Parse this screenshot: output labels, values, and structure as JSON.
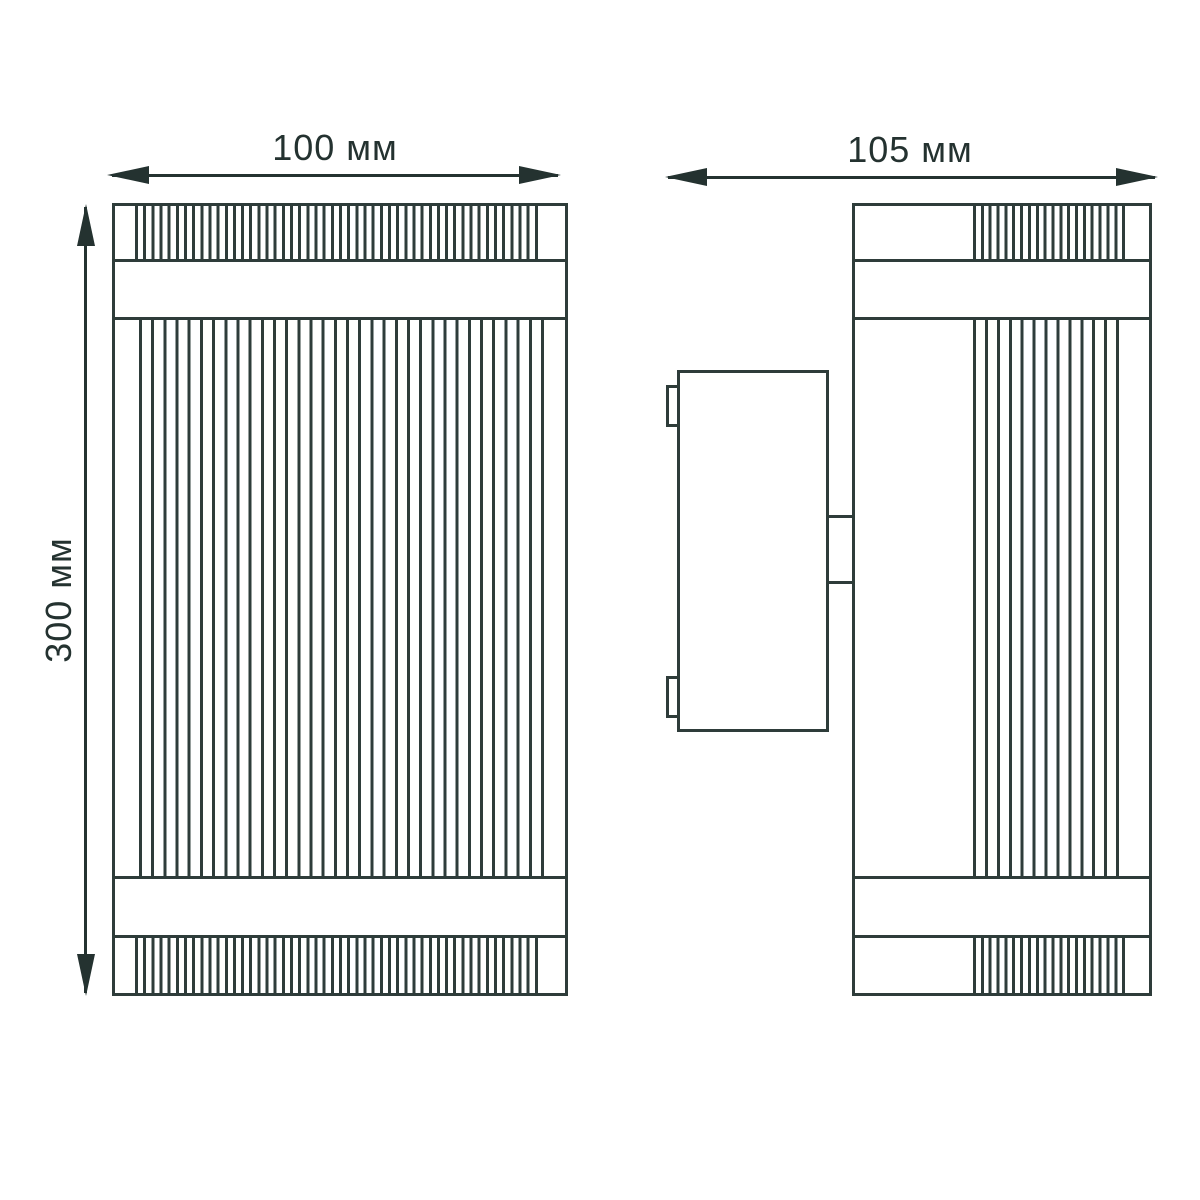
{
  "dimensions": {
    "front_width": {
      "label": "100 мм",
      "value": 100,
      "unit": "мм"
    },
    "side_depth": {
      "label": "105 мм",
      "value": 105,
      "unit": "мм"
    },
    "height": {
      "label": "300 мм",
      "value": 300,
      "unit": "мм"
    }
  },
  "colors": {
    "line": "#2e3c3a",
    "ink": "#243230",
    "background": "#ffffff"
  }
}
